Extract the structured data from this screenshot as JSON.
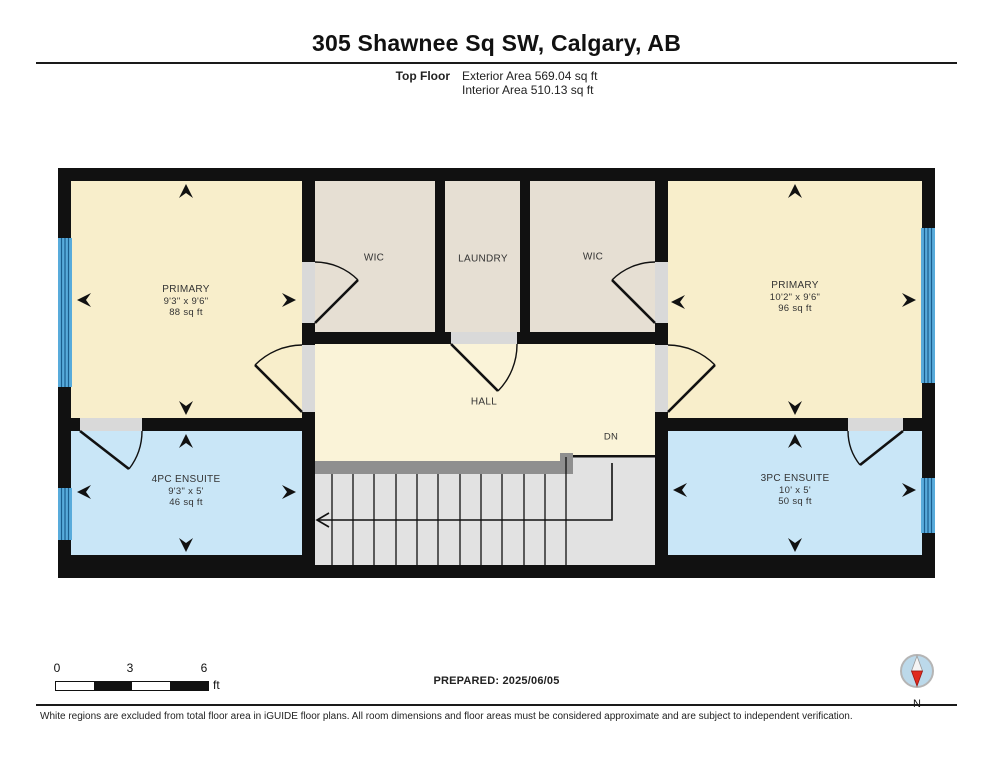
{
  "header": {
    "title": "305 Shawnee Sq SW, Calgary, AB",
    "floor_label": "Top Floor",
    "exterior_area": "Exterior Area 569.04 sq ft",
    "interior_area": "Interior Area 510.13 sq ft"
  },
  "rooms": {
    "primary_left": {
      "name": "PRIMARY",
      "dims": "9'3\" x 9'6\"",
      "area": "88 sq ft"
    },
    "wic_left": {
      "name": "WIC"
    },
    "laundry": {
      "name": "LAUNDRY"
    },
    "wic_right": {
      "name": "WIC"
    },
    "primary_right": {
      "name": "PRIMARY",
      "dims": "10'2\" x 9'6\"",
      "area": "96 sq ft"
    },
    "hall": {
      "name": "HALL"
    },
    "stairs": {
      "label": "DN"
    },
    "ensuite_4pc": {
      "name": "4PC ENSUITE",
      "dims": "9'3\" x 5'",
      "area": "46 sq ft"
    },
    "ensuite_3pc": {
      "name": "3PC ENSUITE",
      "dims": "10' x 5'",
      "area": "50 sq ft"
    }
  },
  "scale_bar": {
    "ticks": [
      "0",
      "3",
      "6"
    ],
    "unit": "ft"
  },
  "prepared": "PREPARED: 2025/06/05",
  "compass": {
    "label": "N"
  },
  "footer_note": "White regions are excluded from total floor area in iGUIDE floor plans. All room dimensions and floor areas must be considered approximate and are subject to independent verification.",
  "colors": {
    "wall": "#111111",
    "bedroom_fill": "#f8eecb",
    "hall_fill": "#faf3d8",
    "closet_fill": "#e6dfd3",
    "bathroom_fill": "#c9e6f7",
    "window_blue": "#58abdb",
    "stairs_fill": "#e2e2e2",
    "railing_gray": "#8f8f8f",
    "compass_north_red": "#e02a1e"
  }
}
